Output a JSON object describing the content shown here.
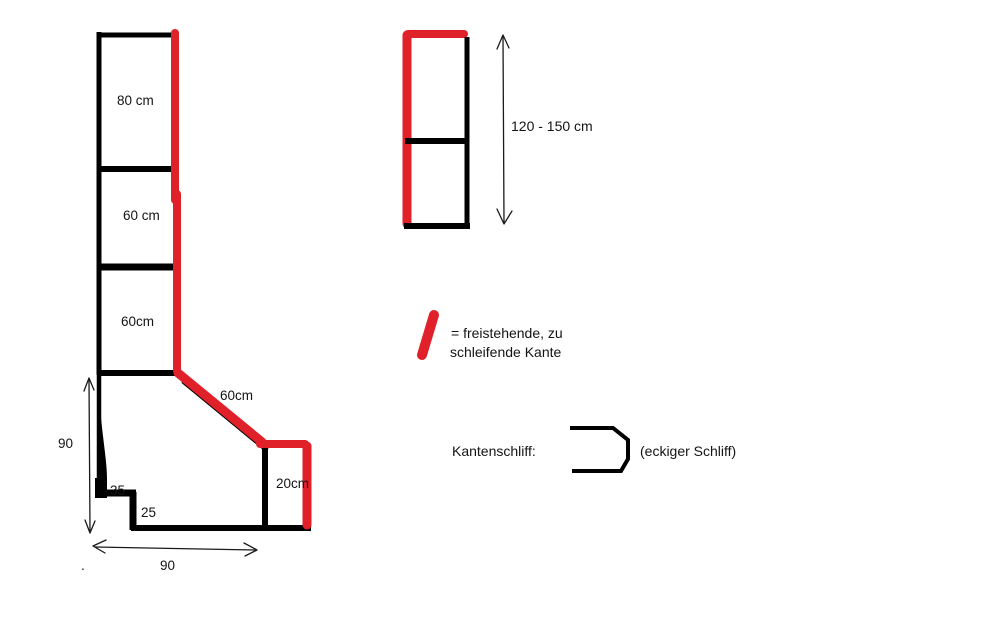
{
  "colors": {
    "red": "#e02129",
    "black": "#000000",
    "background": "#ffffff"
  },
  "left_figure": {
    "segment1_label": "80 cm",
    "segment2_label": "60 cm",
    "segment3_label": "60cm",
    "diagonal_label": "60cm",
    "box_label": "20cm",
    "height_dim_label": "90",
    "width_dim_label": "90",
    "step_upper_label": "35",
    "step_lower_label": "25",
    "stray_dot": "."
  },
  "right_figure": {
    "height_dim_label": "120 - 150 cm"
  },
  "legend": {
    "line1": "= freistehende, zu",
    "line2": "schleifende Kante"
  },
  "edge_grind": {
    "label": "Kantenschliff:",
    "note": "(eckiger Schliff)"
  }
}
